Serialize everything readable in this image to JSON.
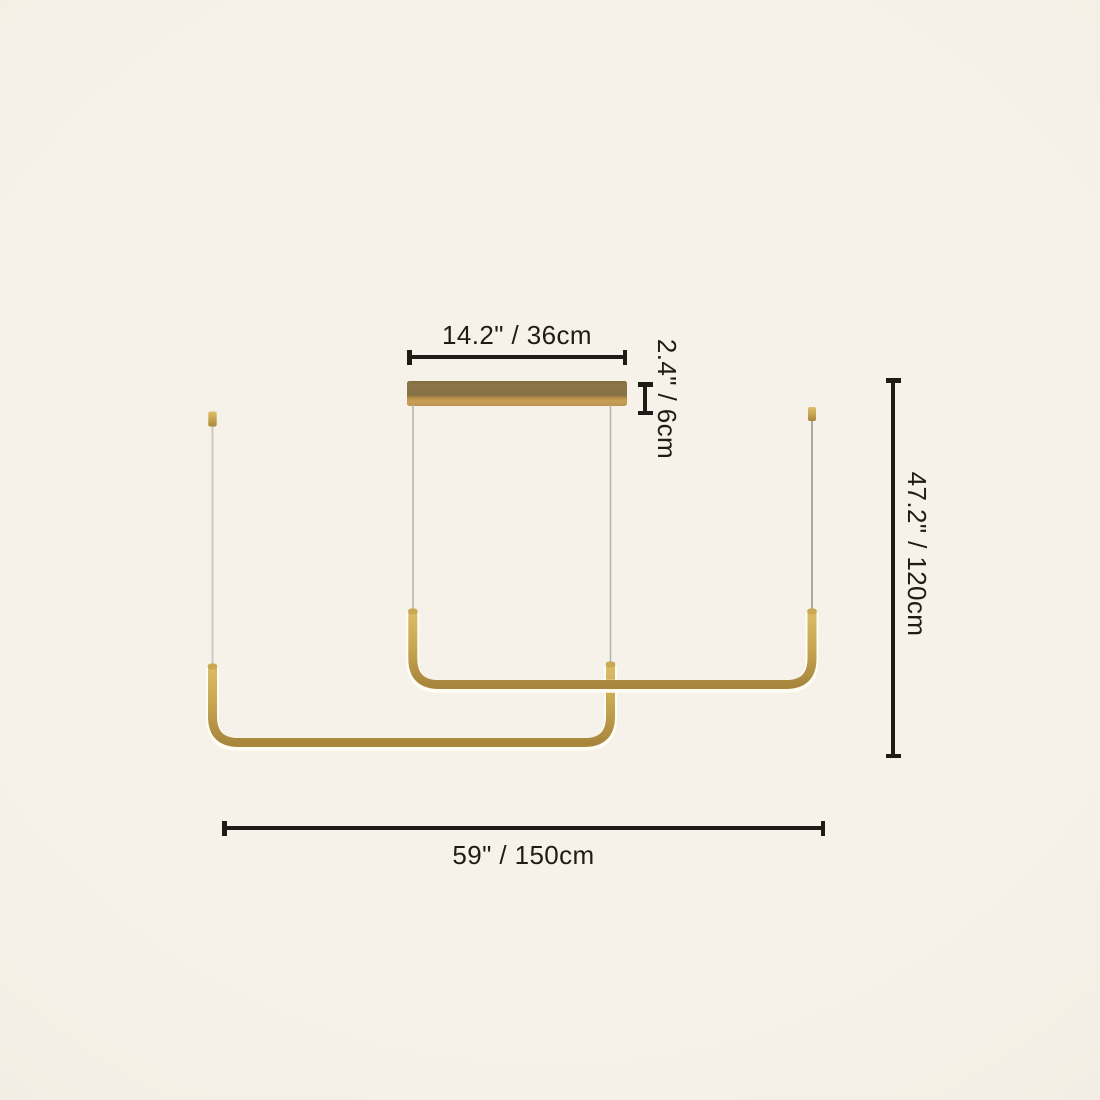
{
  "page": {
    "background_color": "#f5f1e8",
    "description": "Dimension diagram of a two-bar linear LED pendant chandelier"
  },
  "illustration": {
    "name": "linear-pendant-light",
    "colors": {
      "gold_tube": "#c8a551",
      "gold_tube_light": "#dcbd68",
      "gold_tube_dark": "#a8873d",
      "canopy_top": "#877245",
      "canopy_bottom": "#c99f56",
      "led_glow": "#fffdf4",
      "wire_light": "#c9c4ba",
      "wire_medium": "#b7b2a8",
      "wire_dark": "#93908a"
    }
  },
  "annotations": {
    "line_color": "#1f1c17",
    "text_color": "#1f1c17",
    "canopy_width": {
      "label": "14.2\" / 36cm",
      "inches": "14.2\"",
      "cm": "36cm"
    },
    "canopy_depth": {
      "label": "2.4\" / 6cm",
      "inches": "2.4\"",
      "cm": "6cm"
    },
    "drop_height": {
      "label": "47.2\" / 120cm",
      "inches": "47.2\"",
      "cm": "120cm"
    },
    "total_width": {
      "label": "59\" / 150cm",
      "inches": "59\"",
      "cm": "150cm"
    }
  }
}
